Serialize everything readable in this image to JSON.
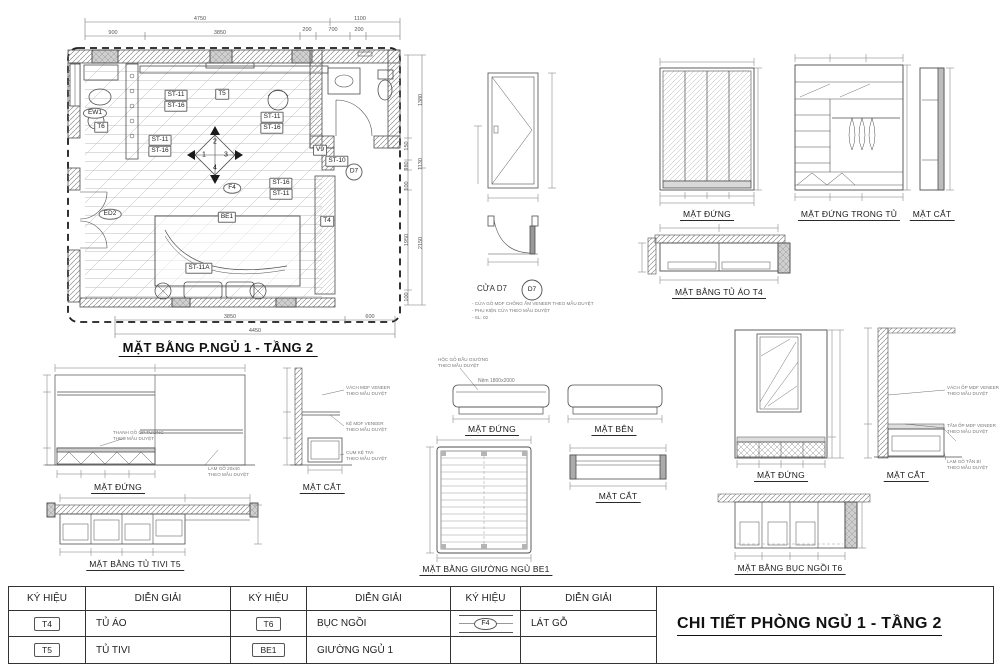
{
  "sheet": {
    "title": "CHI TIẾT PHÒNG NGỦ 1 - TẦNG 2"
  },
  "plan": {
    "title": "MẶT BẰNG P.NGỦ 1 - TẦNG 2",
    "dim_top_total": [
      "4750",
      "1100"
    ],
    "dim_top_parts": [
      "900",
      "3850",
      "200",
      "700",
      "200"
    ],
    "dim_bottom_parts": [
      "3850",
      "600"
    ],
    "dim_bottom_total": "4450",
    "dim_right_parts": [
      "150",
      "980",
      "100",
      "1950",
      "100"
    ],
    "dim_right_totals": [
      "1380",
      "1130",
      "2150"
    ],
    "labels": {
      "ew1": "EW1",
      "t6": "T6",
      "t5": "T5",
      "t4": "T4",
      "st11": "ST-11",
      "st16": "ST-16",
      "st10": "ST-10",
      "st11a": "ST-11A",
      "v9": "V9",
      "d7": "D7",
      "f4": "F4",
      "be1": "BE1",
      "ed2": "ED2",
      "c1": "1",
      "c2": "2",
      "c3": "3",
      "c4": "4"
    }
  },
  "door": {
    "label": "CỬA D7",
    "bubble": "D7",
    "notes": [
      "- CỬA GỖ MDF CHỐNG ẨM VENEER THEO MẪU DUYỆT",
      "- PHỤ KIỆN CỬA THEO MẪU DUYỆT",
      "- SL: 02"
    ]
  },
  "wardrobe": {
    "front_title": "MẶT ĐỨNG",
    "inside_title": "MẶT ĐỨNG TRONG TỦ",
    "section_title": "MẶT CẮT",
    "plan_title": "MẶT BẰNG TỦ ÁO T4"
  },
  "tv": {
    "front_title": "MẶT ĐỨNG",
    "section_title": "MẶT CẮT",
    "plan_title": "MẶT BẰNG TỦ TIVI T5",
    "note_wall": [
      "THANH GỖ ỐP TƯỜNG",
      "THEO MẪU DUYỆT"
    ],
    "note_lam": [
      "LAM GỖ 20x40",
      "THEO MẪU DUYỆT"
    ],
    "sec_notes": [
      [
        "VÁCH MDF VENEER",
        "THEO MẪU DUYỆT"
      ],
      [
        "KỆ MDF VENEER",
        "THEO MẪU DUYỆT"
      ],
      [
        "CỤM KỆ TIVI",
        "THEO MẪU DUYỆT"
      ]
    ]
  },
  "bed": {
    "front_title": "MẶT ĐỨNG",
    "side_title": "MẶT BÊN",
    "plan_title": "MẶT BẰNG GIƯỜNG NGỦ BE1",
    "section_title": "MẶT CẮT",
    "mattress": "Nệm 1800x2000",
    "note": [
      "HỘC GỖ ĐẦU GIƯỜNG",
      "THEO MẪU DUYỆT"
    ]
  },
  "bench": {
    "front_title": "MẶT ĐỨNG",
    "section_title": "MẶT CẮT",
    "plan_title": "MẶT BẰNG BỤC NGỒI T6",
    "sec_notes": [
      [
        "VÁCH ỐP MDF VENEER",
        "THEO MẪU DUYỆT"
      ],
      [
        "TẤM ỐP MDF VENEER",
        "THEO MẪU DUYỆT"
      ],
      [
        "LAM GỖ TẦN BÌ",
        "THEO MẪU DUYỆT"
      ]
    ]
  },
  "legend": {
    "header_sym": "KÝ HIỆU",
    "header_desc": "DIỄN GIẢI",
    "rows": [
      {
        "sym": "T4",
        "desc": "TỦ ÁO"
      },
      {
        "sym": "T5",
        "desc": "TỦ TIVI"
      },
      {
        "sym": "T6",
        "desc": "BỤC NGỒI"
      },
      {
        "sym": "BE1",
        "desc": "GIƯỜNG NGỦ 1"
      },
      {
        "sym": "F4",
        "desc": "LÁT GỖ"
      }
    ]
  }
}
